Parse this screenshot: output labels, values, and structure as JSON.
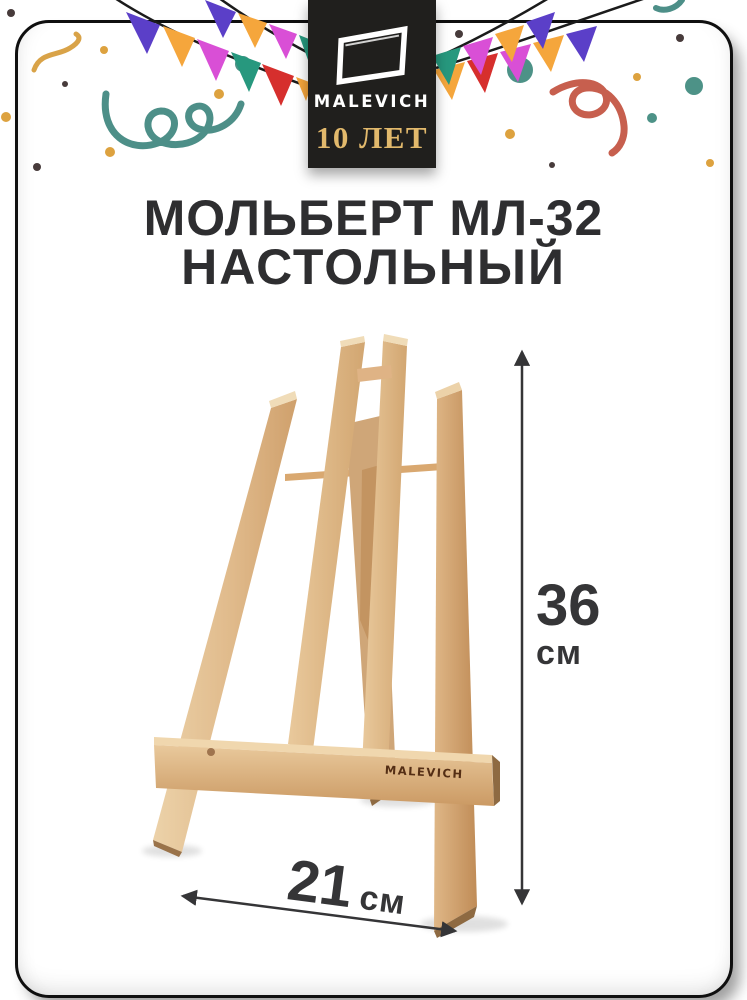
{
  "page": {
    "background": "#ffffff"
  },
  "brand": {
    "name": "MALEVICH",
    "anniversary_label": "10 ЛЕТ"
  },
  "title": {
    "line1": "МОЛЬБЕРТ МЛ-32",
    "line2": "НАСТОЛЬНЫЙ"
  },
  "product": {
    "name": "Мольберт МЛ-32 настольный",
    "engraving": "MALEVICH",
    "dimensions": {
      "height": {
        "value": "36",
        "unit": "см"
      },
      "width": {
        "value": "21",
        "unit": "см"
      }
    }
  },
  "palette": {
    "card_border": "#0f0f0f",
    "logo_bg": "#201f1d",
    "logo_text": "#ffffff",
    "anniversary_gold": "#e2b96c",
    "title_color": "#2e2e30",
    "dimension_color": "#353537",
    "string_black": "#1b1b1b",
    "flag_violet": "#5b3fc8",
    "flag_yellow": "#f5a63c",
    "flag_magenta": "#d94fd6",
    "flag_teal": "#27987e",
    "flag_red": "#d62f2d",
    "confetti_teal": "#4d9287",
    "confetti_gold": "#dda23f",
    "confetti_dark": "#473b3b",
    "squiggle_teal": "#4d8f88",
    "squiggle_red": "#c75f4e",
    "squiggle_gold": "#d9a348",
    "wood_light": "#ecd2a9",
    "wood_mid": "#dbae7d",
    "wood_shade": "#c99a66",
    "wood_dark": "#8e6a42",
    "engraving_brown": "#542e15"
  }
}
